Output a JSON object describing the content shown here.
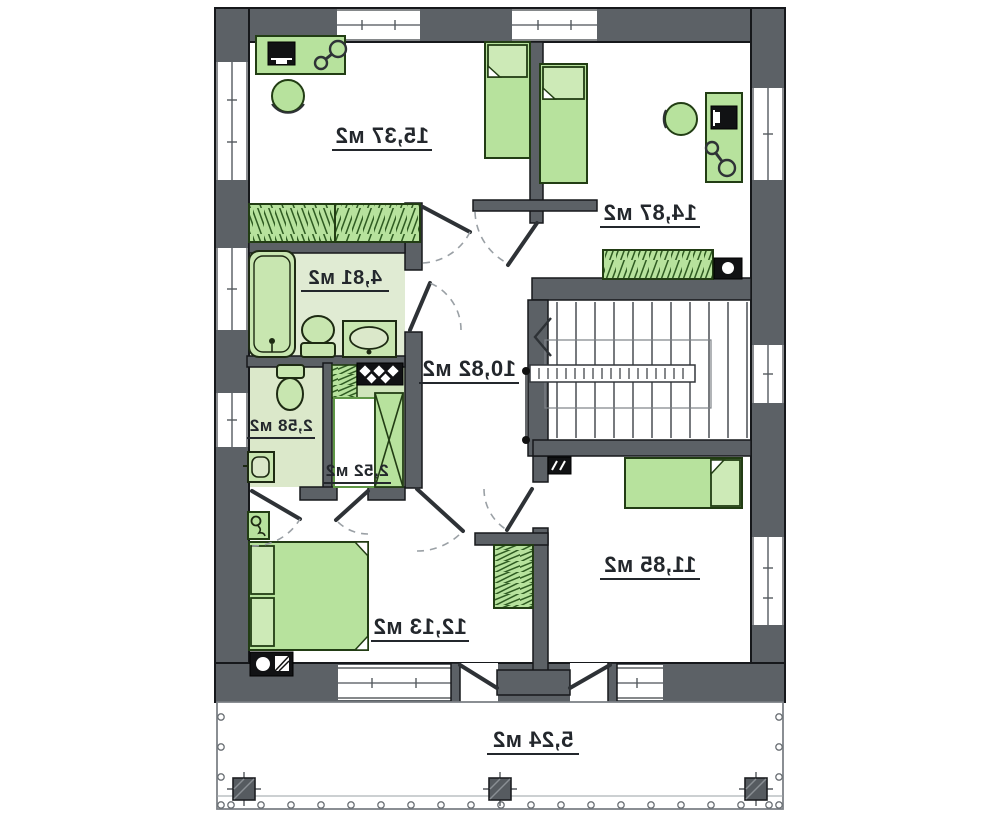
{
  "plan": {
    "type": "floor-plan",
    "mirrored": true,
    "unit": "м2",
    "rooms": [
      {
        "id": "bedroom-top-left",
        "area_label": "15,37 м2"
      },
      {
        "id": "bedroom-top-right",
        "area_label": "14,87 м2"
      },
      {
        "id": "bathroom",
        "area_label": "4,81 м2"
      },
      {
        "id": "hall",
        "area_label": "10,82 м2"
      },
      {
        "id": "wc",
        "area_label": "2,58 м2"
      },
      {
        "id": "closet",
        "area_label": "2,52 м2"
      },
      {
        "id": "bedroom-bottom-left",
        "area_label": "12,13 м2"
      },
      {
        "id": "bedroom-bottom-right",
        "area_label": "11,85 м2"
      },
      {
        "id": "balcony",
        "area_label": "5,24 м2"
      }
    ],
    "colors": {
      "wall": "#5c6166",
      "furniture_green": "#b7e29d",
      "bath_floor": "#e0ebd3",
      "wc_floor": "#dbe8ca",
      "closet_floor": "#cfe5bb",
      "label_text": "#23272c"
    },
    "icons": [
      "bed-icon",
      "desk-icon",
      "monitor-icon",
      "desk-lamp-icon",
      "stool-icon",
      "wardrobe-icon",
      "bathtub-icon",
      "toilet-icon",
      "sink-icon",
      "washbasin-icon",
      "stairs-icon",
      "stair-direction-arrow-icon",
      "radiator-icon",
      "vent-panel-icon",
      "dresser-icon",
      "nightstand-lamp-icon",
      "column-icon",
      "baluster-icon",
      "door-leaf-icon"
    ]
  }
}
